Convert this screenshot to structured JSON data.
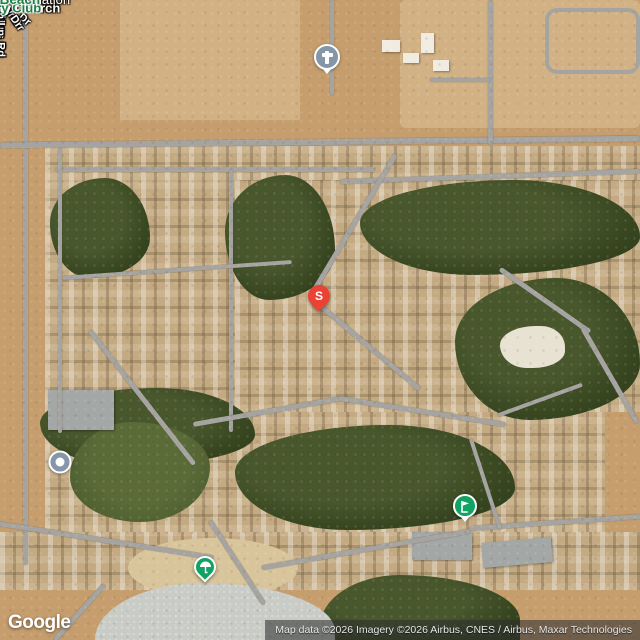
{
  "colors": {
    "desert": "#c69e6e",
    "desert_light": "#d2b285",
    "golf_green": "#36451f",
    "road": "#a6a4a0",
    "water": "#c9ccc6",
    "label_white": "#ffffff",
    "poi_green_text": "#1b7f41",
    "marker_red": "#ea4335",
    "marker_slate": "#8496a7",
    "marker_green": "#12a262",
    "attribution_text": "#e8e8e8"
  },
  "labels": {
    "church": "Silver Lakes\nCommunity Church",
    "brookside_ln": "Brookside Ln",
    "smithson_rd": "Smithson Rd",
    "coolglen_dr": "Coolglen Dr",
    "tournament_dr": "Tournament Dr",
    "mountain_springs_rd": "Mountain Springs Rd",
    "fairacres_ln": "Fairacres Ln",
    "robin_ln": "Robin Ln",
    "evergreen_ln": "Evergreen Ln",
    "blue_grass_dr": "Blue Grass Dr",
    "greenbriar_dr": "Greenbriar Dr",
    "association": "Silver Lakes Association",
    "country_club": "Silver Lakes\nCountry Club",
    "north_beach": "North Beach",
    "lakeview_dr": "Lakeview Dr",
    "clubhouse_dr": "Clubhouse Dr",
    "pkwy_partial": "kwy"
  },
  "markers": {
    "s_pin_letter": "S"
  },
  "google_logo": "Google",
  "attribution": "Map data ©2026 Imagery ©2026 Airbus, CNES / Airbus, Maxar Technologies"
}
